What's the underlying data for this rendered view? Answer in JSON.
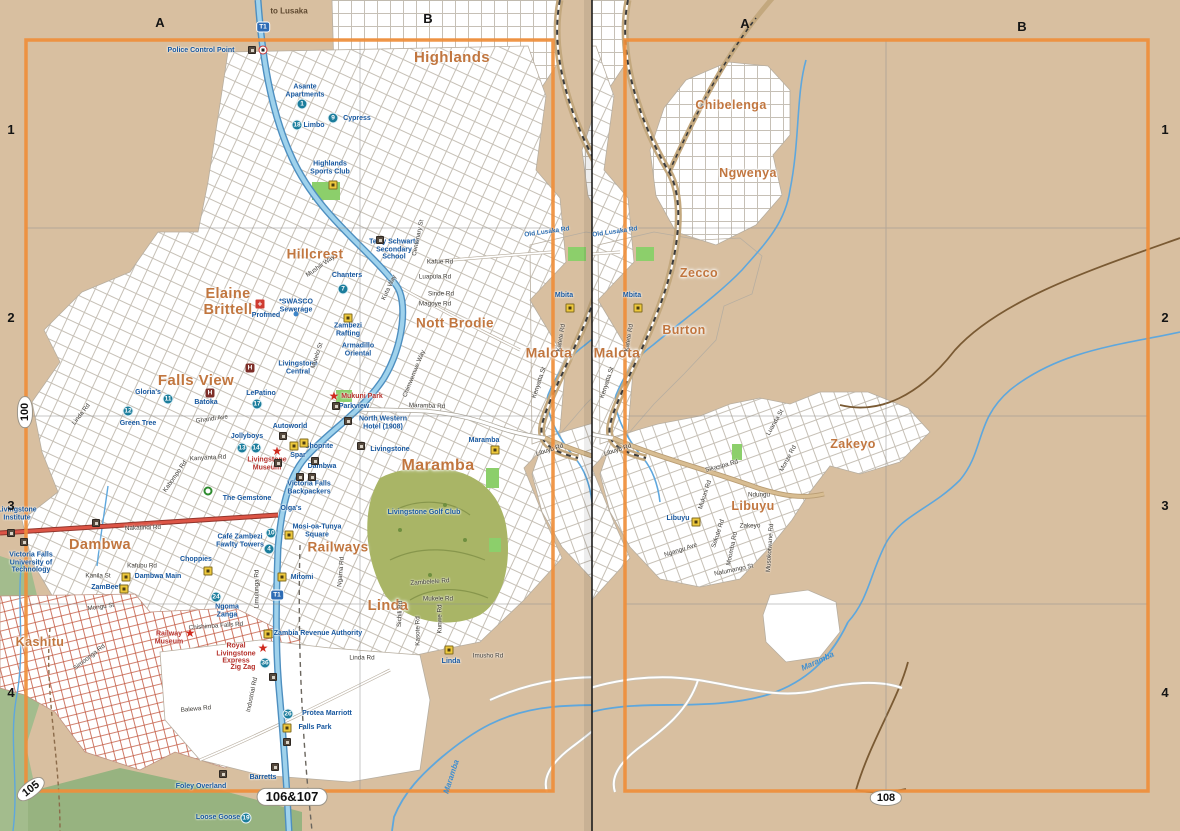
{
  "map_title_refs": {
    "left_page": "106&107",
    "right_page": "108",
    "adjacent_page_left": "100",
    "adjacent_page_corner": "105"
  },
  "colors": {
    "paper": "#d8bfa0",
    "frame_orange": "#ef8e3a",
    "district": "#c1763f",
    "poi_blue": "#15569e",
    "poi_red": "#b5302a",
    "t1_road": "#9fd2ec",
    "nakatindi_red": "#dd5546",
    "river": "#5ea7dd",
    "golf_green": "#a9b566"
  },
  "furniture": {
    "letters": [
      {
        "t": "A",
        "x": 160,
        "y": 23
      },
      {
        "t": "B",
        "x": 428,
        "y": 19
      },
      {
        "t": "A",
        "x": 745,
        "y": 24
      },
      {
        "t": "B",
        "x": 1022,
        "y": 27
      }
    ],
    "numbers": [
      {
        "t": "1",
        "x": 11,
        "y": 130
      },
      {
        "t": "2",
        "x": 11,
        "y": 318
      },
      {
        "t": "3",
        "x": 11,
        "y": 506
      },
      {
        "t": "4",
        "x": 11,
        "y": 693
      },
      {
        "t": "1",
        "x": 1165,
        "y": 130
      },
      {
        "t": "2",
        "x": 1165,
        "y": 318
      },
      {
        "t": "3",
        "x": 1165,
        "y": 506
      },
      {
        "t": "4",
        "x": 1165,
        "y": 693
      }
    ],
    "refs": [
      {
        "t": "100",
        "x": 25,
        "y": 412,
        "r": -90,
        "c": "oval"
      },
      {
        "t": "105",
        "x": 31,
        "y": 789,
        "r": -38,
        "c": "oval"
      },
      {
        "t": "106&107",
        "x": 292,
        "y": 797,
        "r": 0,
        "c": "oval wide"
      },
      {
        "t": "108",
        "x": 886,
        "y": 798,
        "r": 0,
        "c": "oval"
      }
    ]
  },
  "world": {
    "labels": [
      {
        "t": "Highlands",
        "x": 452,
        "y": 58,
        "c": "d",
        "s": 15
      },
      {
        "t": "Hillcrest",
        "x": 315,
        "y": 255,
        "c": "d",
        "s": 13.5
      },
      {
        "t": "Elaine\nBrittell",
        "x": 228,
        "y": 303,
        "c": "d",
        "s": 14.5
      },
      {
        "t": "Nott Brodie",
        "x": 455,
        "y": 324,
        "c": "d",
        "s": 13.5
      },
      {
        "t": "Falls View",
        "x": 196,
        "y": 381,
        "c": "d",
        "s": 15
      },
      {
        "t": "Malota",
        "x": 549,
        "y": 353,
        "c": "d",
        "s": 14
      },
      {
        "t": "Maramba",
        "x": 438,
        "y": 466,
        "c": "d",
        "s": 16
      },
      {
        "t": "Railways",
        "x": 338,
        "y": 548,
        "c": "d",
        "s": 13.5
      },
      {
        "t": "Dambwa",
        "x": 100,
        "y": 546,
        "c": "d",
        "s": 14.5
      },
      {
        "t": "Linda",
        "x": 388,
        "y": 607,
        "c": "d",
        "s": 14.5
      },
      {
        "t": "Kashitu",
        "x": 40,
        "y": 643,
        "c": "d",
        "s": 12.5
      },
      {
        "t": "Chibelenga",
        "x": 663,
        "y": 106,
        "c": "d",
        "s": 12.5
      },
      {
        "t": "Ngwenya",
        "x": 680,
        "y": 174,
        "c": "d",
        "s": 12.5
      },
      {
        "t": "Zecco",
        "x": 631,
        "y": 274,
        "c": "d",
        "s": 12.5
      },
      {
        "t": "Burton",
        "x": 616,
        "y": 331,
        "c": "d",
        "s": 12.5
      },
      {
        "t": "Zakeyo",
        "x": 785,
        "y": 445,
        "c": "d",
        "s": 12.5
      },
      {
        "t": "Libuyu",
        "x": 685,
        "y": 507,
        "c": "d",
        "s": 12.5
      },
      {
        "t": "to Lusaka",
        "x": 289,
        "y": 12,
        "c": "de"
      },
      {
        "t": "Police Control Point",
        "x": 201,
        "y": 51,
        "c": "p"
      },
      {
        "t": "Asante\nApartments",
        "x": 305,
        "y": 91,
        "c": "p"
      },
      {
        "t": "Limbo",
        "x": 314,
        "y": 126,
        "c": "p"
      },
      {
        "t": "Cypress",
        "x": 357,
        "y": 119,
        "c": "p"
      },
      {
        "t": "Highlands\nSports Club",
        "x": 330,
        "y": 168,
        "c": "p"
      },
      {
        "t": "Terry Schwartz\nSecondary\nSchool",
        "x": 394,
        "y": 250,
        "c": "p"
      },
      {
        "t": "Chanters",
        "x": 347,
        "y": 276,
        "c": "p"
      },
      {
        "t": "*SWASCO\nSewerage",
        "x": 296,
        "y": 306,
        "c": "p"
      },
      {
        "t": "Profmed",
        "x": 266,
        "y": 316,
        "c": "p"
      },
      {
        "t": "Zambezi\nRafting",
        "x": 348,
        "y": 330,
        "c": "p"
      },
      {
        "t": "Armadillo\nOriental",
        "x": 358,
        "y": 350,
        "c": "p"
      },
      {
        "t": "Livingstone\nCentral",
        "x": 298,
        "y": 368,
        "c": "p"
      },
      {
        "t": "Batoka",
        "x": 206,
        "y": 403,
        "c": "p"
      },
      {
        "t": "Gloria's",
        "x": 148,
        "y": 393,
        "c": "p"
      },
      {
        "t": "Green Tree",
        "x": 138,
        "y": 424,
        "c": "p"
      },
      {
        "t": "LePatino",
        "x": 261,
        "y": 394,
        "c": "p"
      },
      {
        "t": "Jollyboys",
        "x": 247,
        "y": 437,
        "c": "p"
      },
      {
        "t": "Autoworld",
        "x": 290,
        "y": 427,
        "c": "p"
      },
      {
        "t": "Spar",
        "x": 298,
        "y": 456,
        "c": "p"
      },
      {
        "t": "Shoprite",
        "x": 319,
        "y": 447,
        "c": "p"
      },
      {
        "t": "Dambwa",
        "x": 322,
        "y": 467,
        "c": "p"
      },
      {
        "t": "Victoria Falls\nBackpackers",
        "x": 309,
        "y": 488,
        "c": "p"
      },
      {
        "t": "The Gemstone",
        "x": 247,
        "y": 499,
        "c": "p"
      },
      {
        "t": "Olga's",
        "x": 291,
        "y": 509,
        "c": "p"
      },
      {
        "t": "Mosi-oa-Tunya\nSquare",
        "x": 317,
        "y": 531,
        "c": "p"
      },
      {
        "t": "Café Zambezi\nFawlty Towers",
        "x": 240,
        "y": 541,
        "c": "p"
      },
      {
        "t": "Choppies",
        "x": 196,
        "y": 560,
        "c": "p"
      },
      {
        "t": "Dambwa Main",
        "x": 158,
        "y": 577,
        "c": "p"
      },
      {
        "t": "ZamBeef",
        "x": 106,
        "y": 588,
        "c": "p"
      },
      {
        "t": "Ngoma\nZanga",
        "x": 227,
        "y": 611,
        "c": "p"
      },
      {
        "t": "Mitomi",
        "x": 302,
        "y": 578,
        "c": "p"
      },
      {
        "t": "Zambia Revenue Authority",
        "x": 318,
        "y": 634,
        "c": "p"
      },
      {
        "t": "Protea Marriott",
        "x": 327,
        "y": 714,
        "c": "p"
      },
      {
        "t": "Falls Park",
        "x": 315,
        "y": 728,
        "c": "p"
      },
      {
        "t": "Barretts",
        "x": 263,
        "y": 778,
        "c": "p"
      },
      {
        "t": "Foley Overland",
        "x": 201,
        "y": 787,
        "c": "p"
      },
      {
        "t": "Loose Goose",
        "x": 218,
        "y": 818,
        "c": "p"
      },
      {
        "t": "Victoria Falls\nUniversity of\nTechnology",
        "x": 31,
        "y": 563,
        "c": "p"
      },
      {
        "t": "Livingstone\nInstitute",
        "x": 17,
        "y": 514,
        "c": "p"
      },
      {
        "t": "North Western\nHotel (1908)",
        "x": 383,
        "y": 423,
        "c": "p"
      },
      {
        "t": "Livingstone",
        "x": 390,
        "y": 450,
        "c": "p"
      },
      {
        "t": "Parkview",
        "x": 354,
        "y": 407,
        "c": "p"
      },
      {
        "t": "Maramba",
        "x": 484,
        "y": 441,
        "c": "p"
      },
      {
        "t": "Livingstone Golf Club",
        "x": 424,
        "y": 513,
        "c": "p"
      },
      {
        "t": "Mbita",
        "x": 564,
        "y": 296,
        "c": "p"
      },
      {
        "t": "Libuyu",
        "x": 610,
        "y": 519,
        "c": "p"
      },
      {
        "t": "Linda",
        "x": 451,
        "y": 662,
        "c": "p"
      },
      {
        "t": "Mukuni Park",
        "x": 362,
        "y": 397,
        "c": "pr"
      },
      {
        "t": "Livingstone\nMuseum",
        "x": 267,
        "y": 464,
        "c": "pr"
      },
      {
        "t": "Railway\nMuseum",
        "x": 169,
        "y": 638,
        "c": "pr"
      },
      {
        "t": "Royal\nLivingstone\nExpress",
        "x": 236,
        "y": 654,
        "c": "pr"
      },
      {
        "t": "Zig Zag",
        "x": 243,
        "y": 668,
        "c": "pr"
      },
      {
        "t": "Mushili Way",
        "x": 321,
        "y": 267,
        "c": "r",
        "r": -35
      },
      {
        "t": "Centenary St",
        "x": 419,
        "y": 238,
        "c": "r",
        "r": -78
      },
      {
        "t": "Kafue Rd",
        "x": 440,
        "y": 263,
        "c": "r"
      },
      {
        "t": "Luapula Rd",
        "x": 435,
        "y": 278,
        "c": "r"
      },
      {
        "t": "Sinde Rd",
        "x": 441,
        "y": 295,
        "c": "r"
      },
      {
        "t": "Magoye Rd",
        "x": 435,
        "y": 305,
        "c": "r"
      },
      {
        "t": "Old Lusaka Rd",
        "x": 547,
        "y": 232,
        "c": "rb",
        "r": -8
      },
      {
        "t": "Maramba Rd",
        "x": 427,
        "y": 407,
        "c": "r",
        "r": 2
      },
      {
        "t": "Libuyu Rd",
        "x": 550,
        "y": 451,
        "c": "r",
        "r": -18
      },
      {
        "t": "Nakatindi Rd",
        "x": 143,
        "y": 529,
        "c": "r",
        "r": -2
      },
      {
        "t": "Kafubu Rd",
        "x": 142,
        "y": 567,
        "c": "r"
      },
      {
        "t": "Kanila St",
        "x": 98,
        "y": 577,
        "c": "r"
      },
      {
        "t": "Mongu St",
        "x": 101,
        "y": 608,
        "c": "r",
        "r": -8
      },
      {
        "t": "Limulunga Rd",
        "x": 258,
        "y": 589,
        "c": "r",
        "r": -90
      },
      {
        "t": "Ngama Rd",
        "x": 342,
        "y": 572,
        "c": "r",
        "r": -85
      },
      {
        "t": "Kanyanta Rd",
        "x": 208,
        "y": 459,
        "c": "r",
        "r": -3
      },
      {
        "t": "Ghandi Ave",
        "x": 212,
        "y": 420,
        "c": "r",
        "r": -8
      },
      {
        "t": "Kabompo Rd",
        "x": 176,
        "y": 477,
        "c": "r",
        "r": -55
      },
      {
        "t": "Chishimba Falls Rd",
        "x": 216,
        "y": 627,
        "c": "r",
        "r": -4
      },
      {
        "t": "Balewa Rd",
        "x": 196,
        "y": 710,
        "c": "r",
        "r": -5
      },
      {
        "t": "Industrial Rd",
        "x": 253,
        "y": 695,
        "c": "r",
        "r": -78
      },
      {
        "t": "Linda Rd",
        "x": 362,
        "y": 659,
        "c": "r"
      },
      {
        "t": "Linda Rd",
        "x": 82,
        "y": 415,
        "c": "r",
        "r": -52
      },
      {
        "t": "Zambelele Rd",
        "x": 430,
        "y": 583,
        "c": "r",
        "r": -4
      },
      {
        "t": "Mukele Rd",
        "x": 438,
        "y": 600,
        "c": "r"
      },
      {
        "t": "Imusho Rd",
        "x": 488,
        "y": 657,
        "c": "r"
      },
      {
        "t": "Kasote Rd",
        "x": 419,
        "y": 631,
        "c": "r",
        "r": -90
      },
      {
        "t": "Sichili Rd",
        "x": 401,
        "y": 614,
        "c": "r",
        "r": -87
      },
      {
        "t": "Kunwe Rd",
        "x": 441,
        "y": 619,
        "c": "r",
        "r": -90
      },
      {
        "t": "Kenyatta St",
        "x": 540,
        "y": 383,
        "c": "r",
        "r": -72
      },
      {
        "t": "Katete Rd",
        "x": 562,
        "y": 338,
        "c": "r",
        "r": -80
      },
      {
        "t": "Mutelo St",
        "x": 318,
        "y": 356,
        "c": "r",
        "r": -72
      },
      {
        "t": "Kuta Way",
        "x": 390,
        "y": 288,
        "c": "r",
        "r": -65
      },
      {
        "t": "Chimwemwe Way",
        "x": 415,
        "y": 374,
        "c": "r",
        "r": -68
      },
      {
        "t": "Simoonga Rd",
        "x": 90,
        "y": 658,
        "c": "r",
        "r": -38
      },
      {
        "t": "Sikasipa Rd",
        "x": 654,
        "y": 467,
        "c": "r",
        "r": -15
      },
      {
        "t": "Mukuni Rd",
        "x": 638,
        "y": 495,
        "c": "r",
        "r": -72
      },
      {
        "t": "Ndungu",
        "x": 691,
        "y": 496,
        "c": "r"
      },
      {
        "t": "Zakeyo",
        "x": 682,
        "y": 527,
        "c": "r"
      },
      {
        "t": "Sekute Rd",
        "x": 651,
        "y": 534,
        "c": "r",
        "r": -72
      },
      {
        "t": "Moomba Rd",
        "x": 665,
        "y": 549,
        "c": "r",
        "r": -78
      },
      {
        "t": "Musokotwane Rd",
        "x": 703,
        "y": 548,
        "c": "r",
        "r": -86
      },
      {
        "t": "Nalumango St",
        "x": 666,
        "y": 571,
        "c": "r",
        "r": -12
      },
      {
        "t": "Ngangu Ave",
        "x": 613,
        "y": 551,
        "c": "r",
        "r": -18
      },
      {
        "t": "Monze Rd",
        "x": 721,
        "y": 459,
        "c": "r",
        "r": -62
      },
      {
        "t": "Luanda St",
        "x": 708,
        "y": 423,
        "c": "r",
        "r": -60
      },
      {
        "t": "Maramba",
        "x": 452,
        "y": 777,
        "c": "rv",
        "r": -72
      },
      {
        "t": "Maramba",
        "x": 750,
        "y": 662,
        "c": "rv",
        "r": -25
      }
    ],
    "markers": [
      {
        "k": "c",
        "n": "1",
        "x": 302,
        "y": 104
      },
      {
        "k": "c",
        "n": "18",
        "x": 297,
        "y": 125
      },
      {
        "k": "c",
        "n": "9",
        "x": 333,
        "y": 118
      },
      {
        "k": "c",
        "n": "7",
        "x": 343,
        "y": 289
      },
      {
        "k": "c",
        "n": "11",
        "x": 168,
        "y": 399
      },
      {
        "k": "c",
        "n": "12",
        "x": 128,
        "y": 411
      },
      {
        "k": "c",
        "n": "17",
        "x": 257,
        "y": 404
      },
      {
        "k": "c",
        "n": "13",
        "x": 242,
        "y": 448
      },
      {
        "k": "c",
        "n": "14",
        "x": 256,
        "y": 448
      },
      {
        "k": "c",
        "n": "10",
        "x": 271,
        "y": 533
      },
      {
        "k": "c",
        "n": "4",
        "x": 269,
        "y": 549
      },
      {
        "k": "c",
        "n": "24",
        "x": 216,
        "y": 597
      },
      {
        "k": "c",
        "n": "36",
        "x": 265,
        "y": 663
      },
      {
        "k": "c",
        "n": "26",
        "x": 288,
        "y": 714
      },
      {
        "k": "c",
        "n": "19",
        "x": 246,
        "y": 818
      },
      {
        "k": "h",
        "x": 250,
        "y": 368
      },
      {
        "k": "h",
        "x": 210,
        "y": 393
      },
      {
        "k": "cross",
        "x": 260,
        "y": 304
      },
      {
        "k": "star",
        "x": 334,
        "y": 396
      },
      {
        "k": "star",
        "x": 277,
        "y": 451
      },
      {
        "k": "star",
        "x": 190,
        "y": 633
      },
      {
        "k": "star",
        "x": 263,
        "y": 648
      },
      {
        "k": "y",
        "x": 348,
        "y": 318
      },
      {
        "k": "y",
        "x": 495,
        "y": 450
      },
      {
        "k": "y",
        "x": 570,
        "y": 308
      },
      {
        "k": "y",
        "x": 628,
        "y": 522
      },
      {
        "k": "y",
        "x": 449,
        "y": 650
      },
      {
        "k": "y",
        "x": 282,
        "y": 577
      },
      {
        "k": "y",
        "x": 289,
        "y": 535
      },
      {
        "k": "y",
        "x": 208,
        "y": 571
      },
      {
        "k": "y",
        "x": 124,
        "y": 589
      },
      {
        "k": "y",
        "x": 126,
        "y": 577
      },
      {
        "k": "y",
        "x": 268,
        "y": 634
      },
      {
        "k": "y",
        "x": 287,
        "y": 728
      },
      {
        "k": "y",
        "x": 304,
        "y": 443
      },
      {
        "k": "y",
        "x": 294,
        "y": 446
      },
      {
        "k": "y",
        "x": 333,
        "y": 185
      },
      {
        "k": "b",
        "x": 380,
        "y": 240
      },
      {
        "k": "b",
        "x": 348,
        "y": 421
      },
      {
        "k": "b",
        "x": 336,
        "y": 406
      },
      {
        "k": "b",
        "x": 361,
        "y": 446
      },
      {
        "k": "b",
        "x": 300,
        "y": 477
      },
      {
        "k": "b",
        "x": 312,
        "y": 477
      },
      {
        "k": "b",
        "x": 278,
        "y": 463
      },
      {
        "k": "b",
        "x": 315,
        "y": 461
      },
      {
        "k": "b",
        "x": 283,
        "y": 436
      },
      {
        "k": "b",
        "x": 96,
        "y": 523
      },
      {
        "k": "b",
        "x": 11,
        "y": 533
      },
      {
        "k": "b",
        "x": 24,
        "y": 542
      },
      {
        "k": "b",
        "x": 223,
        "y": 774
      },
      {
        "k": "b",
        "x": 275,
        "y": 767
      },
      {
        "k": "b",
        "x": 287,
        "y": 742
      },
      {
        "k": "b",
        "x": 273,
        "y": 677
      },
      {
        "k": "b",
        "x": 252,
        "y": 50
      },
      {
        "k": "gem",
        "x": 208,
        "y": 491
      },
      {
        "k": "police",
        "x": 263,
        "y": 50
      },
      {
        "k": "shield",
        "n": "T1",
        "x": 263,
        "y": 27
      },
      {
        "k": "shield",
        "n": "T1",
        "x": 277,
        "y": 595
      },
      {
        "k": "dot",
        "x": 296,
        "y": 314
      }
    ]
  }
}
